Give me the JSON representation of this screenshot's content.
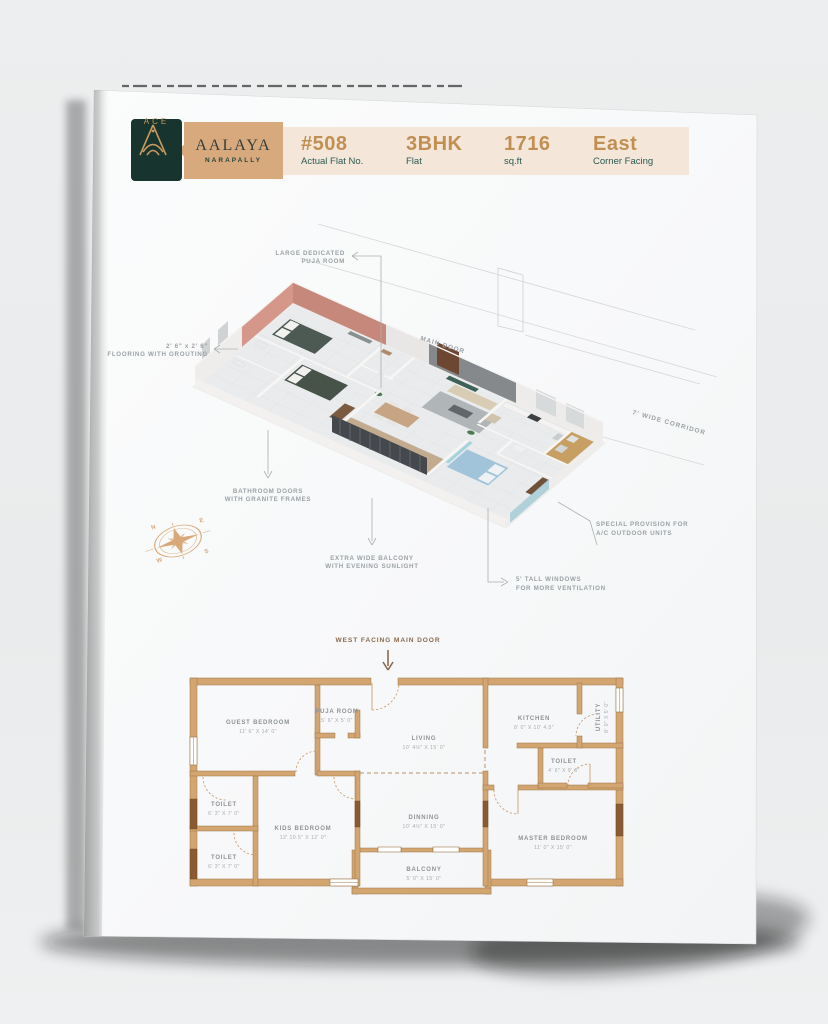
{
  "header": {
    "brand": {
      "logo_text": "ACE",
      "project": "AALAYA",
      "location": "NARAPALLY"
    },
    "stats": [
      {
        "value": "#508",
        "label": "Actual Flat No."
      },
      {
        "value": "3BHK",
        "label": "Flat"
      },
      {
        "value": "1716",
        "label": "sq.ft"
      },
      {
        "value": "East",
        "label": "Corner Facing"
      }
    ]
  },
  "colors": {
    "brand_green": "#17342E",
    "brand_tan": "#D9A97E",
    "strip_beige": "#F4E7D9",
    "stat_gold": "#C18F52",
    "stat_teal": "#2B5A52",
    "wall_tan": "#D3A571",
    "callout_gray": "#9BA1A5",
    "compass_gold": "#D9A878"
  },
  "plan3d": {
    "callouts": {
      "puja": {
        "line1": "LARGE DEDICATED",
        "line2": "PUJA ROOM"
      },
      "flooring": {
        "line1": "2' 6\" x 2' 6\"",
        "line2": "FLOORING WITH GROUTING"
      },
      "bathroom": {
        "line1": "BATHROOM DOORS",
        "line2": "WITH GRANITE FRAMES"
      },
      "balcony": {
        "line1": "EXTRA WIDE BALCONY",
        "line2": "WITH EVENING SUNLIGHT"
      },
      "windows": {
        "line1": "5' TALL WINDOWS",
        "line2": "FOR MORE VENTILATION"
      },
      "ac": {
        "line1": "SPECIAL PROVISION FOR",
        "line2": "A/C OUTDOOR UNITS"
      },
      "corridor": "7' WIDE CORRIDOR",
      "main_door": "MAIN DOOR"
    },
    "compass": {
      "n": "N",
      "e": "E",
      "s": "S",
      "w": "W"
    }
  },
  "plan2d": {
    "main_door_label": "WEST FACING MAIN DOOR",
    "rooms": [
      {
        "name": "GUEST BEDROOM",
        "dims": "11' 6\" X 14' 0\""
      },
      {
        "name": "PUJA ROOM",
        "dims": "5' 6\" X 5' 0\""
      },
      {
        "name": "LIVING",
        "dims": "10' 4½\" X 15' 0\""
      },
      {
        "name": "KITCHEN",
        "dims": "8' 0\" X 10' 4.5\""
      },
      {
        "name": "UTILITY",
        "dims": "8' 0\" X 5' 0\""
      },
      {
        "name": "TOILET",
        "dims": "4' 6\" X 9' 0\""
      },
      {
        "name": "TOILET",
        "dims": "6' 3\" X 7' 0\""
      },
      {
        "name": "KIDS BEDROOM",
        "dims": "12' 10.5\" X 12' 0\""
      },
      {
        "name": "TOILET",
        "dims": "6' 3\" X 7' 0\""
      },
      {
        "name": "DINNING",
        "dims": "10' 4½\" X 15' 0\""
      },
      {
        "name": "BALCONY",
        "dims": "5' 0\" X 15' 0\""
      },
      {
        "name": "MASTER BEDROOM",
        "dims": "11' 0\" X 15' 0\""
      }
    ]
  }
}
